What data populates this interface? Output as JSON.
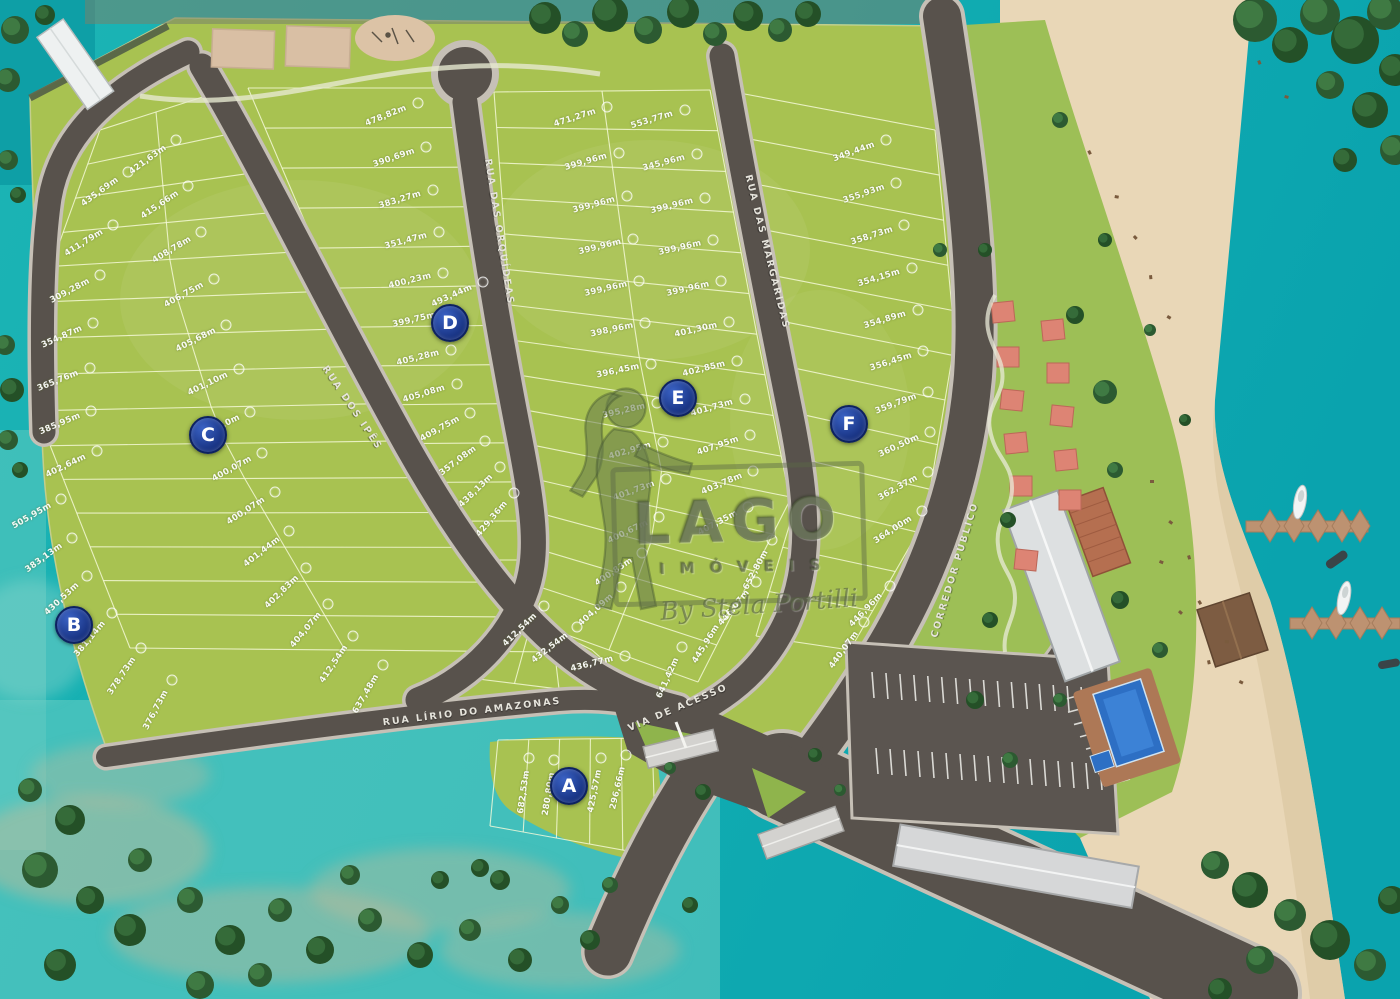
{
  "map": {
    "watermark": {
      "brand": "LAGO",
      "subtitle": "IMÓVEIS",
      "signature": "By Stela Portilli"
    },
    "section_markers": [
      {
        "label": "A",
        "x": 569,
        "y": 786
      },
      {
        "label": "B",
        "x": 74,
        "y": 625
      },
      {
        "label": "C",
        "x": 208,
        "y": 435
      },
      {
        "label": "D",
        "x": 450,
        "y": 323
      },
      {
        "label": "E",
        "x": 678,
        "y": 398
      },
      {
        "label": "F",
        "x": 849,
        "y": 424
      }
    ],
    "streets": [
      {
        "name": "RUA DOS IPÊS",
        "x": 352,
        "y": 408,
        "rot": 56
      },
      {
        "name": "RUA DAS ORQUÍDEAS",
        "x": 499,
        "y": 232,
        "rot": 81
      },
      {
        "name": "RUA DAS MARGARIDAS",
        "x": 767,
        "y": 252,
        "rot": 76
      },
      {
        "name": "RUA LÍRIO DO AMAZONAS",
        "x": 472,
        "y": 712,
        "rot": -7
      },
      {
        "name": "VIA DE ACESSO",
        "x": 678,
        "y": 708,
        "rot": -23
      },
      {
        "name": "CORREDOR PÚBLICO",
        "x": 955,
        "y": 570,
        "rot": -73
      }
    ],
    "lots": [
      {
        "t": "435,69m",
        "x": 100,
        "y": 192,
        "r": -36
      },
      {
        "t": "411,79m",
        "x": 84,
        "y": 243,
        "r": -32
      },
      {
        "t": "309,28m",
        "x": 70,
        "y": 291,
        "r": -28
      },
      {
        "t": "354,87m",
        "x": 62,
        "y": 337,
        "r": -24
      },
      {
        "t": "365,76m",
        "x": 58,
        "y": 381,
        "r": -22
      },
      {
        "t": "385,95m",
        "x": 60,
        "y": 424,
        "r": -23
      },
      {
        "t": "402,64m",
        "x": 66,
        "y": 466,
        "r": -26
      },
      {
        "t": "505,95m",
        "x": 32,
        "y": 516,
        "r": -30
      },
      {
        "t": "383,13m",
        "x": 44,
        "y": 558,
        "r": -36
      },
      {
        "t": "430,53m",
        "x": 62,
        "y": 599,
        "r": -43
      },
      {
        "t": "381,14m",
        "x": 90,
        "y": 639,
        "r": -50
      },
      {
        "t": "378,73m",
        "x": 122,
        "y": 676,
        "r": -56
      },
      {
        "t": "376,73m",
        "x": 156,
        "y": 710,
        "r": -62
      },
      {
        "t": "421,63m",
        "x": 148,
        "y": 160,
        "r": -36
      },
      {
        "t": "415,66m",
        "x": 160,
        "y": 205,
        "r": -34
      },
      {
        "t": "408,78m",
        "x": 172,
        "y": 250,
        "r": -31
      },
      {
        "t": "406,75m",
        "x": 184,
        "y": 295,
        "r": -29
      },
      {
        "t": "405,68m",
        "x": 196,
        "y": 340,
        "r": -27
      },
      {
        "t": "401,10m",
        "x": 208,
        "y": 384,
        "r": -26
      },
      {
        "t": "400,10m",
        "x": 220,
        "y": 427,
        "r": -27
      },
      {
        "t": "400,07m",
        "x": 232,
        "y": 469,
        "r": -29
      },
      {
        "t": "400,07m",
        "x": 246,
        "y": 511,
        "r": -33
      },
      {
        "t": "401,44m",
        "x": 262,
        "y": 552,
        "r": -38
      },
      {
        "t": "402,83m",
        "x": 282,
        "y": 592,
        "r": -44
      },
      {
        "t": "404,07m",
        "x": 306,
        "y": 630,
        "r": -50
      },
      {
        "t": "412,54m",
        "x": 334,
        "y": 664,
        "r": -56
      },
      {
        "t": "637,48m",
        "x": 366,
        "y": 694,
        "r": -60
      },
      {
        "t": "478,82m",
        "x": 386,
        "y": 116,
        "r": -22
      },
      {
        "t": "390,69m",
        "x": 394,
        "y": 158,
        "r": -19
      },
      {
        "t": "383,27m",
        "x": 400,
        "y": 200,
        "r": -17
      },
      {
        "t": "351,47m",
        "x": 406,
        "y": 241,
        "r": -15
      },
      {
        "t": "400,23m",
        "x": 410,
        "y": 281,
        "r": -14
      },
      {
        "t": "399,75m",
        "x": 414,
        "y": 320,
        "r": -13
      },
      {
        "t": "493,44m",
        "x": 452,
        "y": 296,
        "r": -24
      },
      {
        "t": "405,28m",
        "x": 418,
        "y": 358,
        "r": -14
      },
      {
        "t": "405,08m",
        "x": 424,
        "y": 394,
        "r": -17
      },
      {
        "t": "409,75m",
        "x": 440,
        "y": 429,
        "r": -29
      },
      {
        "t": "357,08m",
        "x": 458,
        "y": 461,
        "r": -37
      },
      {
        "t": "438,13m",
        "x": 476,
        "y": 491,
        "r": -44
      },
      {
        "t": "429,36m",
        "x": 492,
        "y": 519,
        "r": -50
      },
      {
        "t": "471,27m",
        "x": 575,
        "y": 118,
        "r": -18
      },
      {
        "t": "399,96m",
        "x": 586,
        "y": 162,
        "r": -16
      },
      {
        "t": "399,96m",
        "x": 594,
        "y": 205,
        "r": -15
      },
      {
        "t": "399,96m",
        "x": 600,
        "y": 247,
        "r": -14
      },
      {
        "t": "399,96m",
        "x": 606,
        "y": 289,
        "r": -13
      },
      {
        "t": "398,96m",
        "x": 612,
        "y": 330,
        "r": -12
      },
      {
        "t": "396,45m",
        "x": 618,
        "y": 371,
        "r": -12
      },
      {
        "t": "395,28m",
        "x": 624,
        "y": 411,
        "r": -13
      },
      {
        "t": "402,95m",
        "x": 630,
        "y": 451,
        "r": -16
      },
      {
        "t": "401,73m",
        "x": 634,
        "y": 491,
        "r": -20
      },
      {
        "t": "400,67m",
        "x": 628,
        "y": 532,
        "r": -26
      },
      {
        "t": "400,83m",
        "x": 614,
        "y": 572,
        "r": -34
      },
      {
        "t": "404,09m",
        "x": 596,
        "y": 610,
        "r": -42
      },
      {
        "t": "553,77m",
        "x": 652,
        "y": 120,
        "r": -17
      },
      {
        "t": "345,96m",
        "x": 664,
        "y": 163,
        "r": -15
      },
      {
        "t": "399,96m",
        "x": 672,
        "y": 206,
        "r": -14
      },
      {
        "t": "399,96m",
        "x": 680,
        "y": 248,
        "r": -13
      },
      {
        "t": "399,96m",
        "x": 688,
        "y": 289,
        "r": -13
      },
      {
        "t": "401,30m",
        "x": 696,
        "y": 330,
        "r": -13
      },
      {
        "t": "402,85m",
        "x": 704,
        "y": 369,
        "r": -14
      },
      {
        "t": "401,73m",
        "x": 712,
        "y": 408,
        "r": -16
      },
      {
        "t": "407,95m",
        "x": 718,
        "y": 446,
        "r": -19
      },
      {
        "t": "403,78m",
        "x": 722,
        "y": 484,
        "r": -23
      },
      {
        "t": "407,35m",
        "x": 718,
        "y": 523,
        "r": -28
      },
      {
        "t": "652,80m",
        "x": 756,
        "y": 570,
        "r": -62
      },
      {
        "t": "446,07m",
        "x": 734,
        "y": 608,
        "r": -50
      },
      {
        "t": "445,96m",
        "x": 706,
        "y": 644,
        "r": -58
      },
      {
        "t": "641,42m",
        "x": 668,
        "y": 678,
        "r": -66
      },
      {
        "t": "412,54m",
        "x": 520,
        "y": 630,
        "r": -44
      },
      {
        "t": "432,54m",
        "x": 550,
        "y": 648,
        "r": -38
      },
      {
        "t": "436,77m",
        "x": 592,
        "y": 664,
        "r": -14
      },
      {
        "t": "349,44m",
        "x": 854,
        "y": 152,
        "r": -20
      },
      {
        "t": "355,93m",
        "x": 864,
        "y": 194,
        "r": -19
      },
      {
        "t": "358,73m",
        "x": 872,
        "y": 236,
        "r": -18
      },
      {
        "t": "354,15m",
        "x": 879,
        "y": 278,
        "r": -17
      },
      {
        "t": "354,89m",
        "x": 885,
        "y": 320,
        "r": -17
      },
      {
        "t": "356,45m",
        "x": 891,
        "y": 362,
        "r": -18
      },
      {
        "t": "359,79m",
        "x": 896,
        "y": 404,
        "r": -21
      },
      {
        "t": "360,50m",
        "x": 899,
        "y": 446,
        "r": -25
      },
      {
        "t": "362,37m",
        "x": 898,
        "y": 488,
        "r": -29
      },
      {
        "t": "364,00m",
        "x": 893,
        "y": 530,
        "r": -33
      },
      {
        "t": "446,96m",
        "x": 866,
        "y": 610,
        "r": -46
      },
      {
        "t": "440,07m",
        "x": 844,
        "y": 650,
        "r": -54
      },
      {
        "t": "682,53m",
        "x": 524,
        "y": 792,
        "r": -82
      },
      {
        "t": "280,80m",
        "x": 549,
        "y": 794,
        "r": -81
      },
      {
        "t": "425,57m",
        "x": 595,
        "y": 791,
        "r": -79
      },
      {
        "t": "296,66m",
        "x": 618,
        "y": 788,
        "r": -77
      }
    ]
  }
}
